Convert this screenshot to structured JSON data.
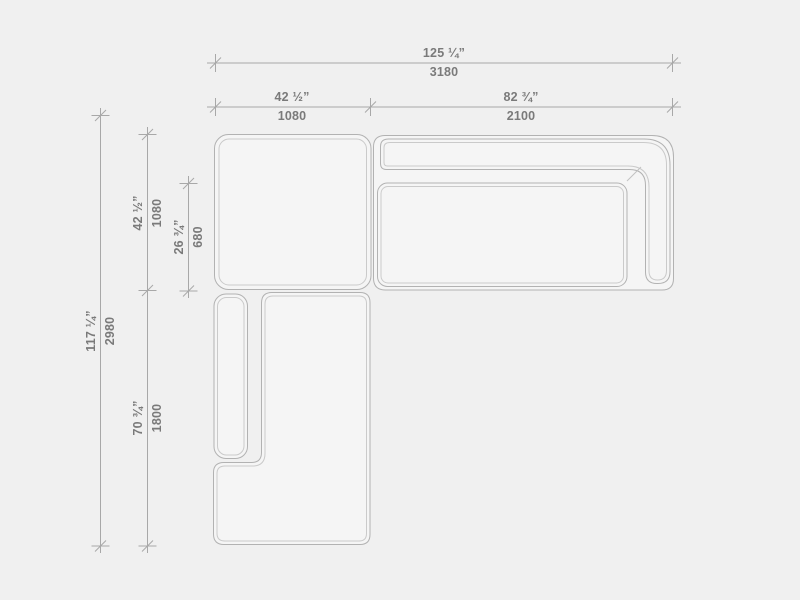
{
  "colors": {
    "background": "#f0f0f0",
    "outline": "#b2b2b2",
    "outline_light": "#cacaca",
    "dim_line": "#a8a8a8",
    "text": "#7a7a7a"
  },
  "dimensions": {
    "overall_width": {
      "inches": "125 ¼”",
      "mm": "3180"
    },
    "left_module_width": {
      "inches": "42 ½”",
      "mm": "1080"
    },
    "sofa_width": {
      "inches": "82 ¾”",
      "mm": "2100"
    },
    "overall_depth": {
      "inches": "117 ¼”",
      "mm": "2980"
    },
    "top_module_depth": {
      "inches": "42 ½”",
      "mm": "1080"
    },
    "seat_depth": {
      "inches": "26 ¾”",
      "mm": "680"
    },
    "chaise_length": {
      "inches": "70 ¾”",
      "mm": "1800"
    }
  }
}
